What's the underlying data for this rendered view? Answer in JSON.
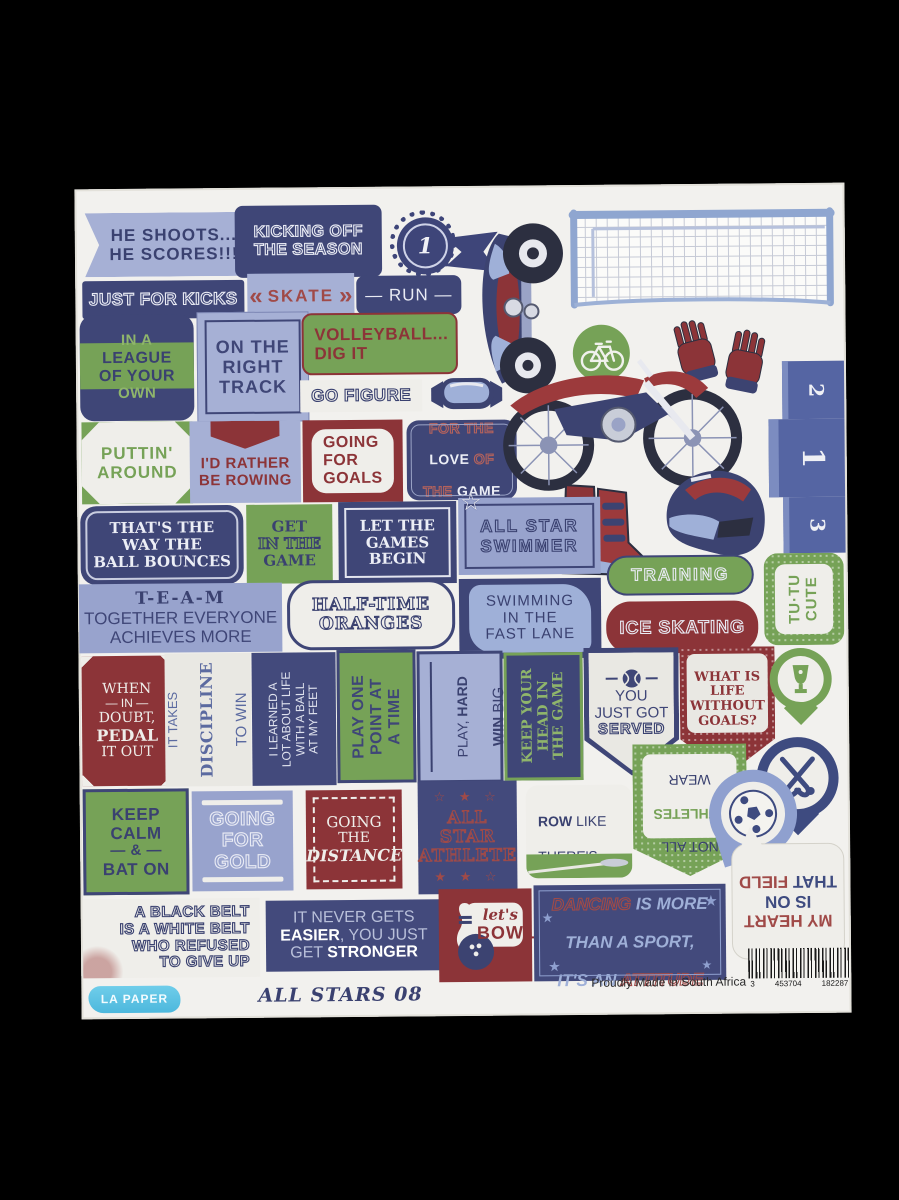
{
  "sheet": {
    "brand": "LA PAPER",
    "collection_title": "ALL STARS 08",
    "made_in": "Proudly Made in South Africa",
    "barcode": {
      "left": "3",
      "mid": "453704",
      "right": "182287"
    }
  },
  "colors": {
    "navy": "#3f4677",
    "periwinkle": "#98a3cd",
    "green": "#76a257",
    "maroon": "#8c3438",
    "offwhite": "#efeeea",
    "brand_blue": "#5ec6e6"
  },
  "podium": {
    "first": "1",
    "second": "2",
    "third": "3"
  },
  "icons": [
    "soccer-goal-icon",
    "quad-bike-icon",
    "motocross-bike-icon",
    "motocross-boots-icon",
    "helmet-icon",
    "gloves-icon",
    "goggles-icon",
    "cycling-badge-icon",
    "award-rosette-icon",
    "winners-podium-icon",
    "trophy-pin-icon",
    "field-hockey-pin-icon",
    "soccer-pin-icon",
    "tennis-ball-icon",
    "bowling-icon"
  ],
  "stickers": {
    "he_shoots": "HE SHOOTS...\nHE SCORES!!!",
    "kicking_off": "KICKING OFF\nTHE SEASON",
    "badge_one": "1",
    "just_for_kicks": "JUST FOR KICKS",
    "skate": {
      "left": "«",
      "word": "SKATE",
      "right": "»"
    },
    "run": "— RUN —",
    "in_a_league": {
      "l1": "IN A",
      "l2": "LEAGUE",
      "l3": "OF YOUR",
      "l4": "OWN"
    },
    "on_track": "ON THE\nRIGHT\nTRACK",
    "volleyball": "VOLLEYBALL...\nDIG IT",
    "go_figure": "GO FIGURE",
    "puttin": "PUTTIN'\nAROUND",
    "rowing": "I'D RATHER\nBE ROWING",
    "goals": "GOING\nFOR\nGOALS",
    "love_game": {
      "l1": "FOR THE",
      "l2a": "LOVE ",
      "l2b": "OF",
      "l3a": "THE ",
      "l3b": "GAME"
    },
    "thats": "THAT'S THE\nWAY THE\nBALL BOUNCES",
    "get_in": {
      "l1": "GET",
      "l2": "IN THE",
      "l3": "GAME"
    },
    "let_games": "LET THE\nGAMES\nBEGIN",
    "swimmer": "ALL STAR\nSWIMMER",
    "swimmer_star": "☆",
    "team": {
      "l1": "T-E-A-M",
      "l2": "TOGETHER EVERYONE",
      "l3": "ACHIEVES MORE"
    },
    "half_time": "HALF-TIME\nORANGES",
    "swimming": "SWIMMING\nIN THE\nFAST LANE",
    "training": "TRAINING",
    "ice_skating": "ICE SKATING",
    "tutu": "TU·TU\nCUTE",
    "when": {
      "l1": "WHEN",
      "l2": "— IN —",
      "l3": "DOUBT,",
      "l4": "PEDAL",
      "l5": "IT OUT"
    },
    "discipline": {
      "l1": "IT TAKES",
      "l2": "DISCIPLINE",
      "l3": "TO WIN"
    },
    "learned": "I LEARNED A\nLOT ABOUT LIFE\nWITH A BALL\nAT MY FEET",
    "one_point": "PLAY ONE\nPOINT AT\nA TIME",
    "play_hard": {
      "l1a": "PLAY, ",
      "l1b": "HARD",
      "l2a": "WIN ",
      "l2b": "BIG"
    },
    "keep_head": "KEEP YOUR\nHEAD IN\nTHE GAME",
    "served": {
      "l1": "YOU",
      "l2": "JUST GOT",
      "l3": "SERVED"
    },
    "what_life": "WHAT IS\nLIFE\nWITHOUT\nGOALS?",
    "keep_calm": {
      "l1": "KEEP",
      "l2": "CALM",
      "l3": "— & —",
      "l4": "BAT ON"
    },
    "gold": "GOING\nFOR\nGOLD",
    "distance": {
      "l1": "GOING",
      "l2": "THE",
      "l3": "DISTANCE"
    },
    "athlete": {
      "stars_top": "☆ ★ ☆",
      "text": "ALL STAR\nATHLETE",
      "stars_bottom": "★ ★ ☆"
    },
    "row_like": {
      "l1a": "ROW",
      "l1b": " LIKE",
      "l2": "THERE'S",
      "l3": "NO",
      "l4a": "TOMO-",
      "l4b": "ROW",
      "l4c": "!"
    },
    "not_all": {
      "l1": "NOT ALL",
      "l2": "ATHLETES",
      "l3": "WEAR",
      "l4": "SHOES"
    },
    "black_belt": "A BLACK BELT\nIS A WHITE BELT\nWHO REFUSED\nTO GIVE UP",
    "it_never": {
      "l1": "IT NEVER GETS",
      "l2a": "EASIER",
      "l2b": ", YOU JUST",
      "l3a": "GET ",
      "l3b": "STRONGER"
    },
    "bowl": {
      "l1": "let's",
      "l2": "BOWL"
    },
    "dancing": {
      "l1a": "DANCING",
      "l1b": " IS MORE",
      "l2": "THAN A SPORT,",
      "l3a": "IT'S AN ",
      "l3b": "ATTITUDE",
      "star": "★"
    },
    "my_heart": {
      "l1": "MY HEART",
      "l2": "IS ON",
      "l3a": "THAT ",
      "l3b": "FIELD"
    }
  }
}
